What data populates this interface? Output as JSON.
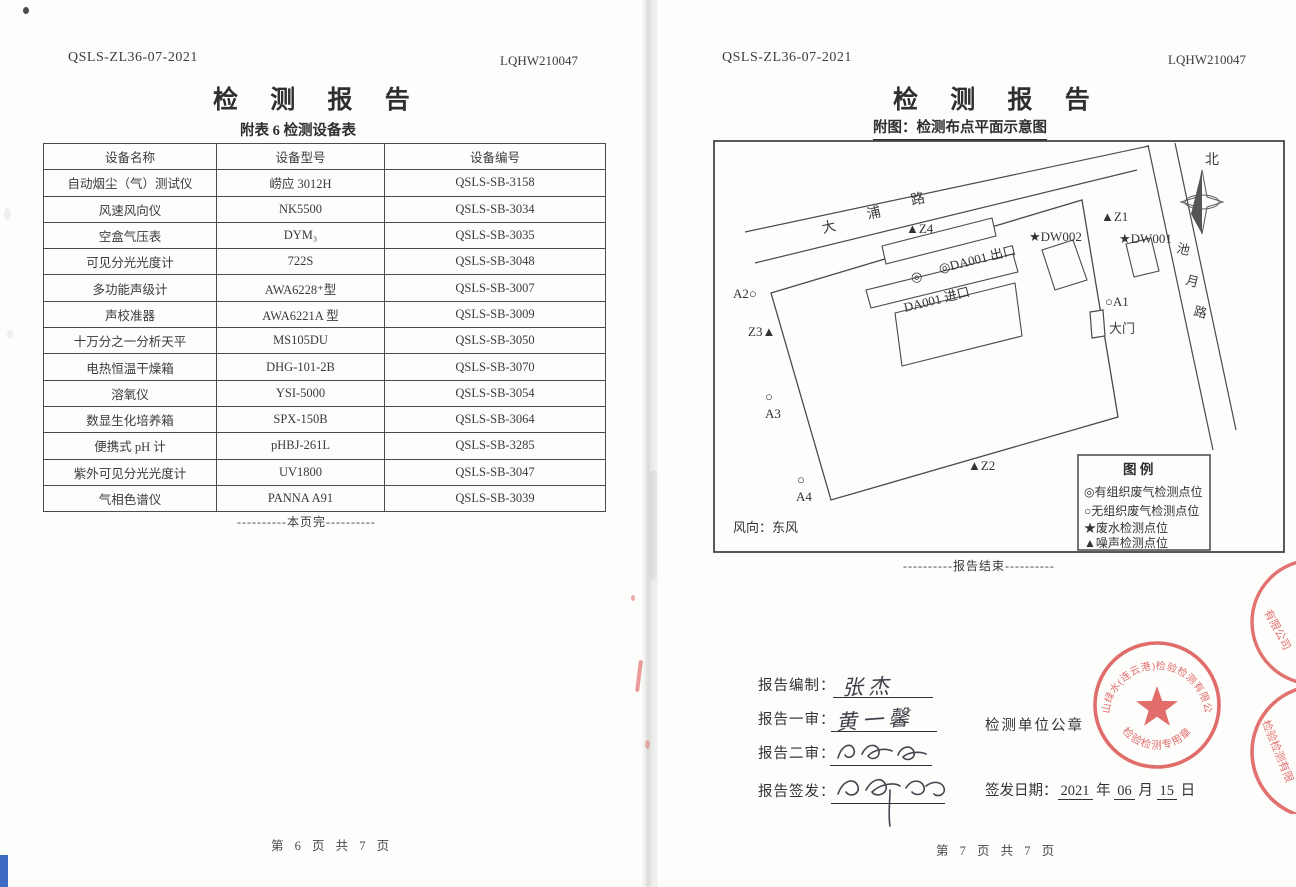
{
  "left_page": {
    "doc_code": "QSLS-ZL36-07-2021",
    "report_no": "LQHW210047",
    "title": "检 测 报 告",
    "subtitle": "附表 6  检测设备表",
    "table": {
      "headers": [
        "设备名称",
        "设备型号",
        "设备编号"
      ],
      "rows": [
        {
          "name": "自动烟尘（气）测试仪",
          "model": "崂应 3012H",
          "no": "QSLS-SB-3158"
        },
        {
          "name": "风速风向仪",
          "model": "NK5500",
          "no": "QSLS-SB-3034"
        },
        {
          "name": "空盒气压表",
          "model": "DYM₃",
          "no": "QSLS-SB-3035"
        },
        {
          "name": "可见分光光度计",
          "model": "722S",
          "no": "QSLS-SB-3048"
        },
        {
          "name": "多功能声级计",
          "model": "AWA6228⁺型",
          "no": "QSLS-SB-3007"
        },
        {
          "name": "声校准器",
          "model": "AWA6221A 型",
          "no": "QSLS-SB-3009"
        },
        {
          "name": "十万分之一分析天平",
          "model": "MS105DU",
          "no": "QSLS-SB-3050"
        },
        {
          "name": "电热恒温干燥箱",
          "model": "DHG-101-2B",
          "no": "QSLS-SB-3070"
        },
        {
          "name": "溶氧仪",
          "model": "YSI-5000",
          "no": "QSLS-SB-3054"
        },
        {
          "name": "数显生化培养箱",
          "model": "SPX-150B",
          "no": "QSLS-SB-3064"
        },
        {
          "name": "便携式 pH 计",
          "model": "pHBJ-261L",
          "no": "QSLS-SB-3285"
        },
        {
          "name": "紫外可见分光光度计",
          "model": "UV1800",
          "no": "QSLS-SB-3047"
        },
        {
          "name": "气相色谱仪",
          "model": "PANNA A91",
          "no": "QSLS-SB-3039"
        }
      ]
    },
    "page_end": "----------本页完----------",
    "page_footer": "第 6 页 共 7 页"
  },
  "right_page": {
    "doc_code": "QSLS-ZL36-07-2021",
    "report_no": "LQHW210047",
    "title": "检 测 报 告",
    "subtitle": "附图：检测布点平面示意图",
    "diagram": {
      "north_label": "北",
      "roads": {
        "dapu_chars": [
          "大",
          "浦",
          "路"
        ],
        "chiyue_chars": [
          "池",
          "月",
          "路"
        ]
      },
      "markers": {
        "z4": "▲Z4",
        "z1": "▲Z1",
        "z2": "▲Z2",
        "z3": "Z3▲",
        "dw002": "★DW002",
        "dw001": "★DW001",
        "da001_outlet": "◎DA001 出口",
        "da001_inlet": "DA001 进口",
        "organized_symbol": "◎",
        "a2": "A2○",
        "a1": "○A1",
        "a3_circle": "○",
        "a3": "A3",
        "a4_circle": "○",
        "a4": "A4",
        "gate": "大门"
      },
      "legend": {
        "title": "图  例",
        "items": [
          "◎有组织废气检测点位",
          "○无组织废气检测点位",
          "★废水检测点位",
          "▲噪声检测点位"
        ]
      },
      "wind": "风向：东风"
    },
    "report_end": "----------报告结束----------",
    "signatures": {
      "prepared_label": "报告编制：",
      "prepared_name": "张杰",
      "review1_label": "报告一审：",
      "review1_name": "黄一馨",
      "review2_label": "报告二审：",
      "issue_label": "报告签发：",
      "seal_caption": "检测单位公章",
      "date_label": "签发日期：",
      "date_year": "2021",
      "year_suffix": "年",
      "date_month": "06",
      "month_suffix": "月",
      "date_day": "15",
      "day_suffix": "日"
    },
    "seal": {
      "company": "青山绿水(连云港)检验检测有限公司",
      "type_text": "检验检测专用章"
    },
    "edge_seals": {
      "fragment1": "有限公司",
      "fragment2": "检验检测有限"
    },
    "page_footer": "第 7 页 共 7 页"
  },
  "colors": {
    "seal_red": "#dd5a57",
    "ink": "#3a3a3a",
    "line": "#4a4a4a"
  }
}
